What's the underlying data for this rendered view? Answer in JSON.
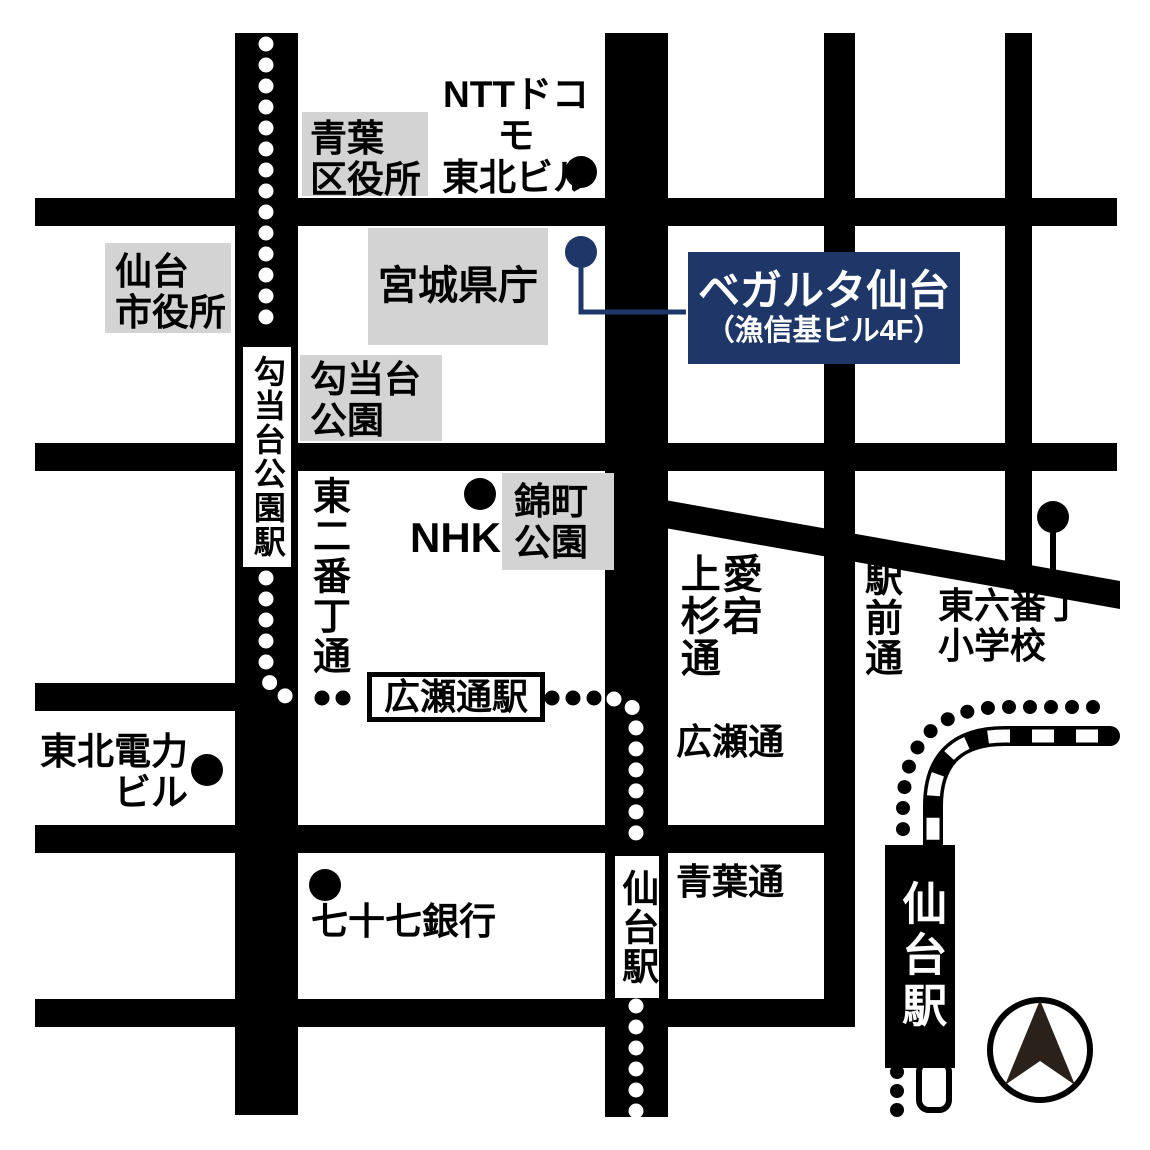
{
  "map": {
    "title": "ベガルタ仙台 アクセスマップ",
    "colors": {
      "road_black": "#000000",
      "landmark_gray": "#d3d3d4",
      "accent_navy": "#1f3768",
      "compass_dark": "#2b211b",
      "background": "#ffffff"
    },
    "destination": {
      "name": "ベガルタ仙台",
      "building": "（漁信基ビル4F）"
    },
    "landmarks": {
      "ntt_docomo": "NTTドコモ\n東北ビル",
      "aoba_ward_office": "青葉\n区役所",
      "sendai_city_hall": "仙台\n市役所",
      "miyagi_pref_office": "宮城県庁",
      "kotodai_park": "勾当台\n公園",
      "nishikicho_park": "錦町\n公園",
      "nhk": "NHK",
      "tohoku_electric_bldg": "東北電力\nビル",
      "bank_77": "七十七銀行",
      "rokubancho_school": "東六番丁\n小学校"
    },
    "stations": {
      "kotodai_koen": "勾当台公園駅",
      "hirose_dori": "広瀬通駅",
      "sendai_road_sign": "仙台駅",
      "sendai_jr": "仙台駅"
    },
    "streets": {
      "higashi_nibancho": "東二番丁通",
      "atago_kamisugi_col_right": "愛宕",
      "atago_kamisugi_col_left": "上杉通",
      "ekimae_dori": "駅前通",
      "hirose_dori": "広瀬通",
      "aoba_dori": "青葉通"
    }
  }
}
